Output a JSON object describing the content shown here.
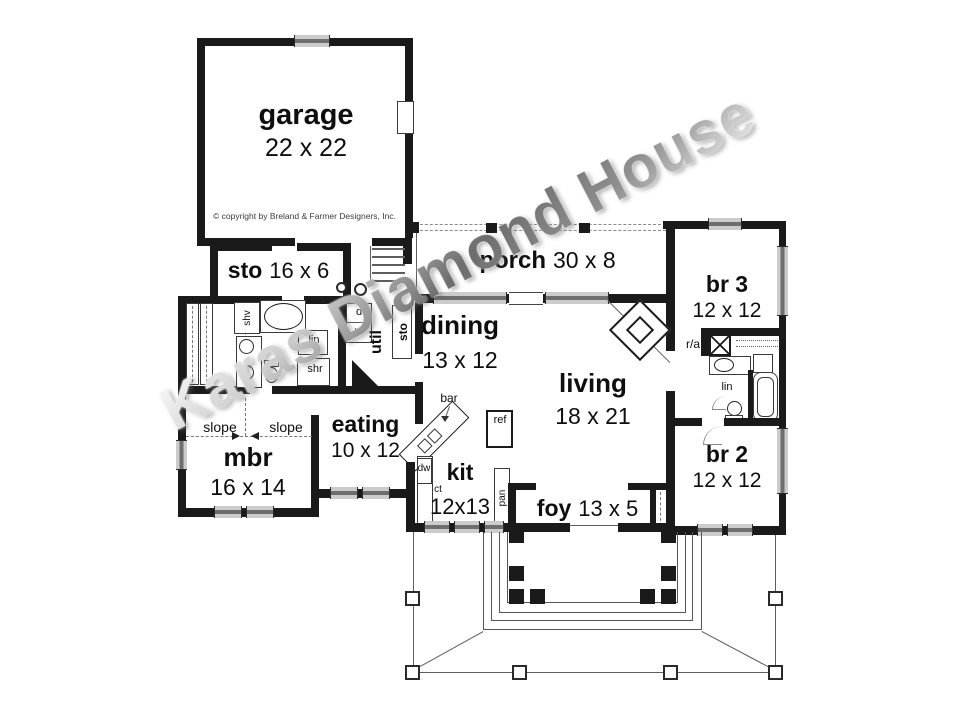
{
  "watermark": "Karas Diamond House",
  "copyright": "© copyright  by Breland & Farmer Designers, Inc.",
  "rooms": {
    "garage": {
      "name": "garage",
      "dims": "22 x 22"
    },
    "sto": {
      "name": "sto",
      "dims": "16 x 6"
    },
    "porch": {
      "name": "porch",
      "dims": "30 x 8"
    },
    "br3": {
      "name": "br 3",
      "dims": "12 x 12"
    },
    "dining": {
      "name": "dining",
      "dims": "13 x 12"
    },
    "living": {
      "name": "living",
      "dims": "18 x 21"
    },
    "eating": {
      "name": "eating",
      "dims": "10 x 12"
    },
    "mbr": {
      "name": "mbr",
      "dims": "16 x 14"
    },
    "kit": {
      "name": "kit",
      "dims": "12x13"
    },
    "foy": {
      "name": "foy",
      "dims": "13 x 5"
    },
    "br2": {
      "name": "br 2",
      "dims": "12 x 12"
    }
  },
  "labels": {
    "slope_left": "slope",
    "slope_right": "slope",
    "util": "util",
    "sto_closet": "sto",
    "dryer": "d",
    "washer": "w",
    "shv": "shv",
    "lin_master": "lin",
    "shr": "shr",
    "bar": "bar",
    "ref": "ref",
    "dw": "dw",
    "ct": "ct",
    "pan": "pan",
    "ra": "r/a",
    "lin_hall": "lin"
  },
  "colors": {
    "wall": "#1a1a1a",
    "window": "#6e6e6e",
    "watermark": "#9a9a9a",
    "background": "#ffffff"
  }
}
